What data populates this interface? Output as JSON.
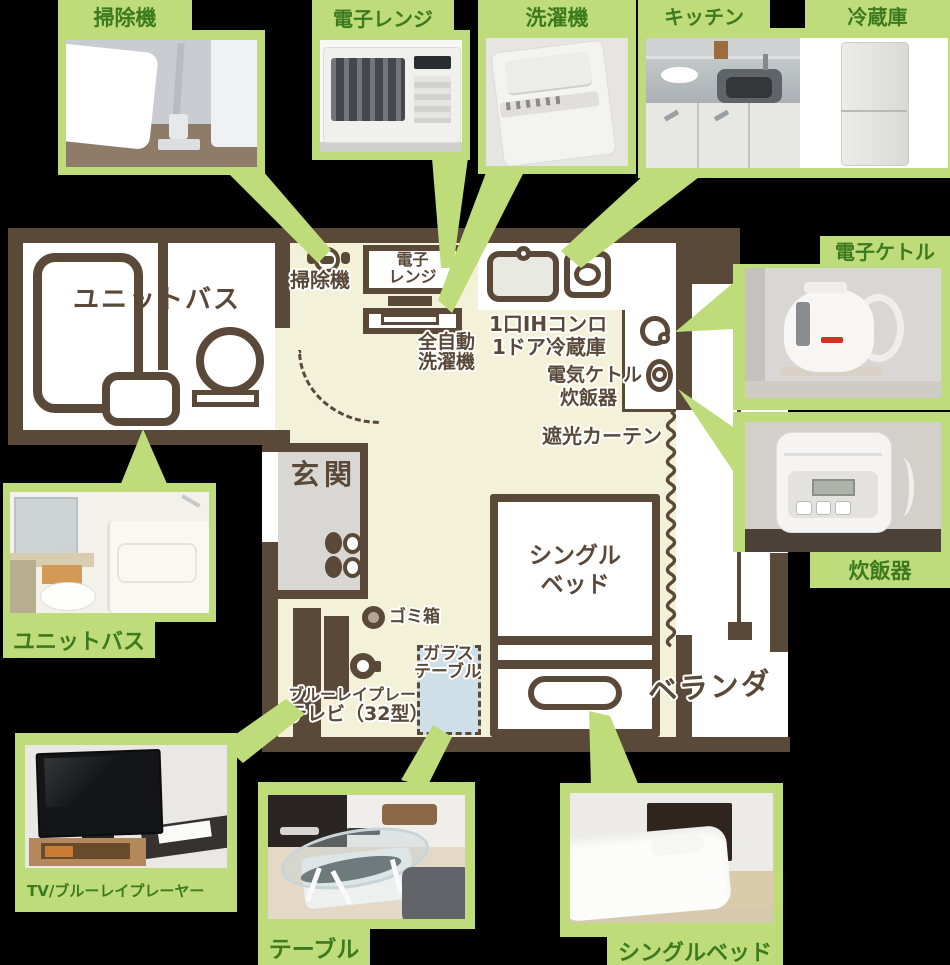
{
  "colors": {
    "background": "#000000",
    "card_green": "#bfdc7a",
    "card_label_green": "#3d7a1f",
    "wall_brown": "#5a4939",
    "floor_cream": "#f3f1d7",
    "room_white": "#ffffff",
    "entrance_gray": "#d8d7d3",
    "glass_table_blue": "#cfdfe8"
  },
  "cards": {
    "vacuum": {
      "label": "掃除機"
    },
    "microwave": {
      "label": "電子レンジ"
    },
    "washer": {
      "label": "洗濯機"
    },
    "kitchen": {
      "label": "キッチン"
    },
    "fridge": {
      "label": "冷蔵庫"
    },
    "kettle": {
      "label": "電子ケトル"
    },
    "rice_cooker": {
      "label": "炊飯器"
    },
    "unit_bath": {
      "label": "ユニットバス"
    },
    "tv": {
      "label": "TV/ブルーレイプレーヤー"
    },
    "table": {
      "label": "テーブル"
    },
    "bed": {
      "label": "シングルベッド"
    }
  },
  "plan": {
    "unit_bath": "ユニットバス",
    "vacuum": "掃除機",
    "microwave_line1": "電子",
    "microwave_line2": "レンジ",
    "washer_line1": "全自動",
    "washer_line2": "洗濯機",
    "stove": "1口IHコンロ",
    "fridge": "1ドア冷蔵庫",
    "kettle": "電気ケトル",
    "rice_cooker": "炊飯器",
    "curtain": "遮光カーテン",
    "entrance": "玄関",
    "bed_line1": "シングル",
    "bed_line2": "ベッド",
    "trash": "ゴミ箱",
    "glass_table_line1": "ガラス",
    "glass_table_line2": "テーブル",
    "bluray": "ブルーレイプレーヤー",
    "tv": "テレビ（32型）",
    "veranda": "ベランダ"
  }
}
